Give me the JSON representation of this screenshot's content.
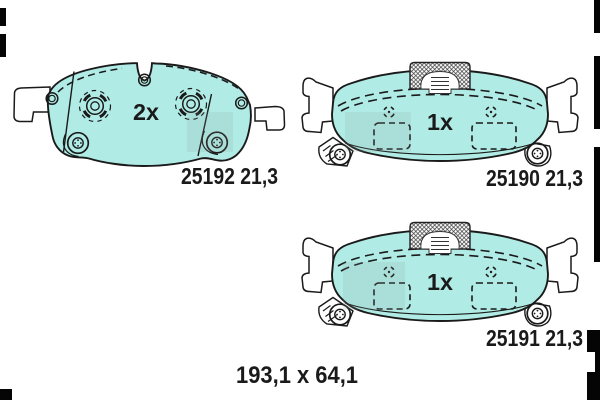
{
  "figure": {
    "subject": "Disc brake pad set technical drawing",
    "pads": [
      {
        "id": "pad-top-left",
        "quantity": "2x",
        "label": "25192 21,3",
        "part_number": "25192",
        "thickness": "21,3"
      },
      {
        "id": "pad-top-right",
        "quantity": "1x",
        "label": "25190 21,3",
        "part_number": "25190",
        "thickness": "21,3"
      },
      {
        "id": "pad-bottom-right",
        "quantity": "1x",
        "label": "25191 21,3",
        "part_number": "25191",
        "thickness": "21,3"
      }
    ],
    "dimensions_label": "193,1 x 64,1",
    "colors": {
      "pad_fill": "#b0ece5",
      "outline": "#1a1a1a",
      "film_mark": "#050505",
      "background": "#ffffff"
    }
  }
}
